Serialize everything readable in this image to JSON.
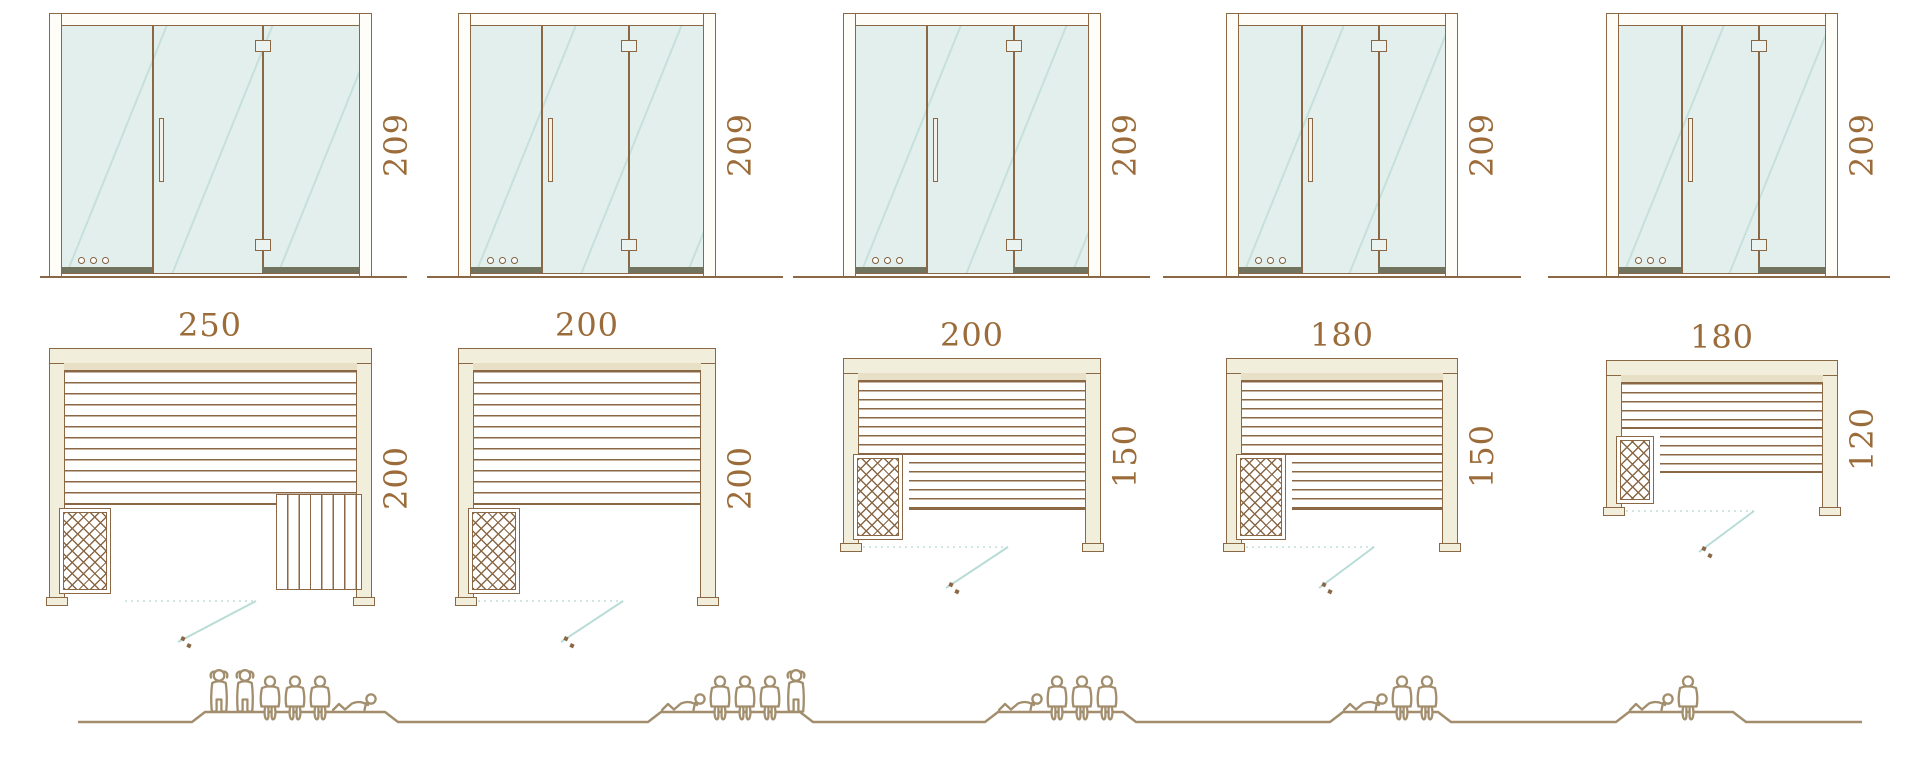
{
  "diagram_title": "Sauna cabin size comparison",
  "colors": {
    "line_brown": "#8b6845",
    "dimension_text": "#9b6c3a",
    "wall_fill": "#f1eedb",
    "glass_fill": "#e2efec",
    "rail_dark": "#72735f",
    "people_outline": "#a28e6d",
    "swing_solid_teal": "#b9dcd7",
    "swing_dotted_teal": "#cfe6e2"
  },
  "icons": {
    "door_handle": "door-handle-icon",
    "door_hinge": "door-hinge-icon",
    "vent_holes": "vent-holes-icon",
    "heater_lattice": "heater-lattice-icon",
    "door_swing": "door-swing-line",
    "person": "person-silhouette-icon"
  },
  "units": [
    {
      "door_height_label": "209",
      "plan_width_label": "250",
      "plan_depth_label": "200",
      "plan_width": 250,
      "plan_depth": 200,
      "capacity": 6,
      "poses": [
        "standing",
        "standing",
        "seated",
        "seated",
        "seated",
        "reclining"
      ]
    },
    {
      "door_height_label": "209",
      "plan_width_label": "200",
      "plan_depth_label": "200",
      "plan_width": 200,
      "plan_depth": 200,
      "capacity": 5,
      "poses": [
        "reclining",
        "seated",
        "seated",
        "seated",
        "standing"
      ]
    },
    {
      "door_height_label": "209",
      "plan_width_label": "200",
      "plan_depth_label": "150",
      "plan_width": 200,
      "plan_depth": 150,
      "capacity": 4,
      "poses": [
        "reclining",
        "seated",
        "seated",
        "seated"
      ]
    },
    {
      "door_height_label": "209",
      "plan_width_label": "180",
      "plan_depth_label": "150",
      "plan_width": 180,
      "plan_depth": 150,
      "capacity": 3,
      "poses": [
        "reclining",
        "seated",
        "seated"
      ]
    },
    {
      "door_height_label": "209",
      "plan_width_label": "180",
      "plan_depth_label": "120",
      "plan_width": 180,
      "plan_depth": 120,
      "capacity": 2,
      "poses": [
        "reclining",
        "seated"
      ]
    }
  ]
}
